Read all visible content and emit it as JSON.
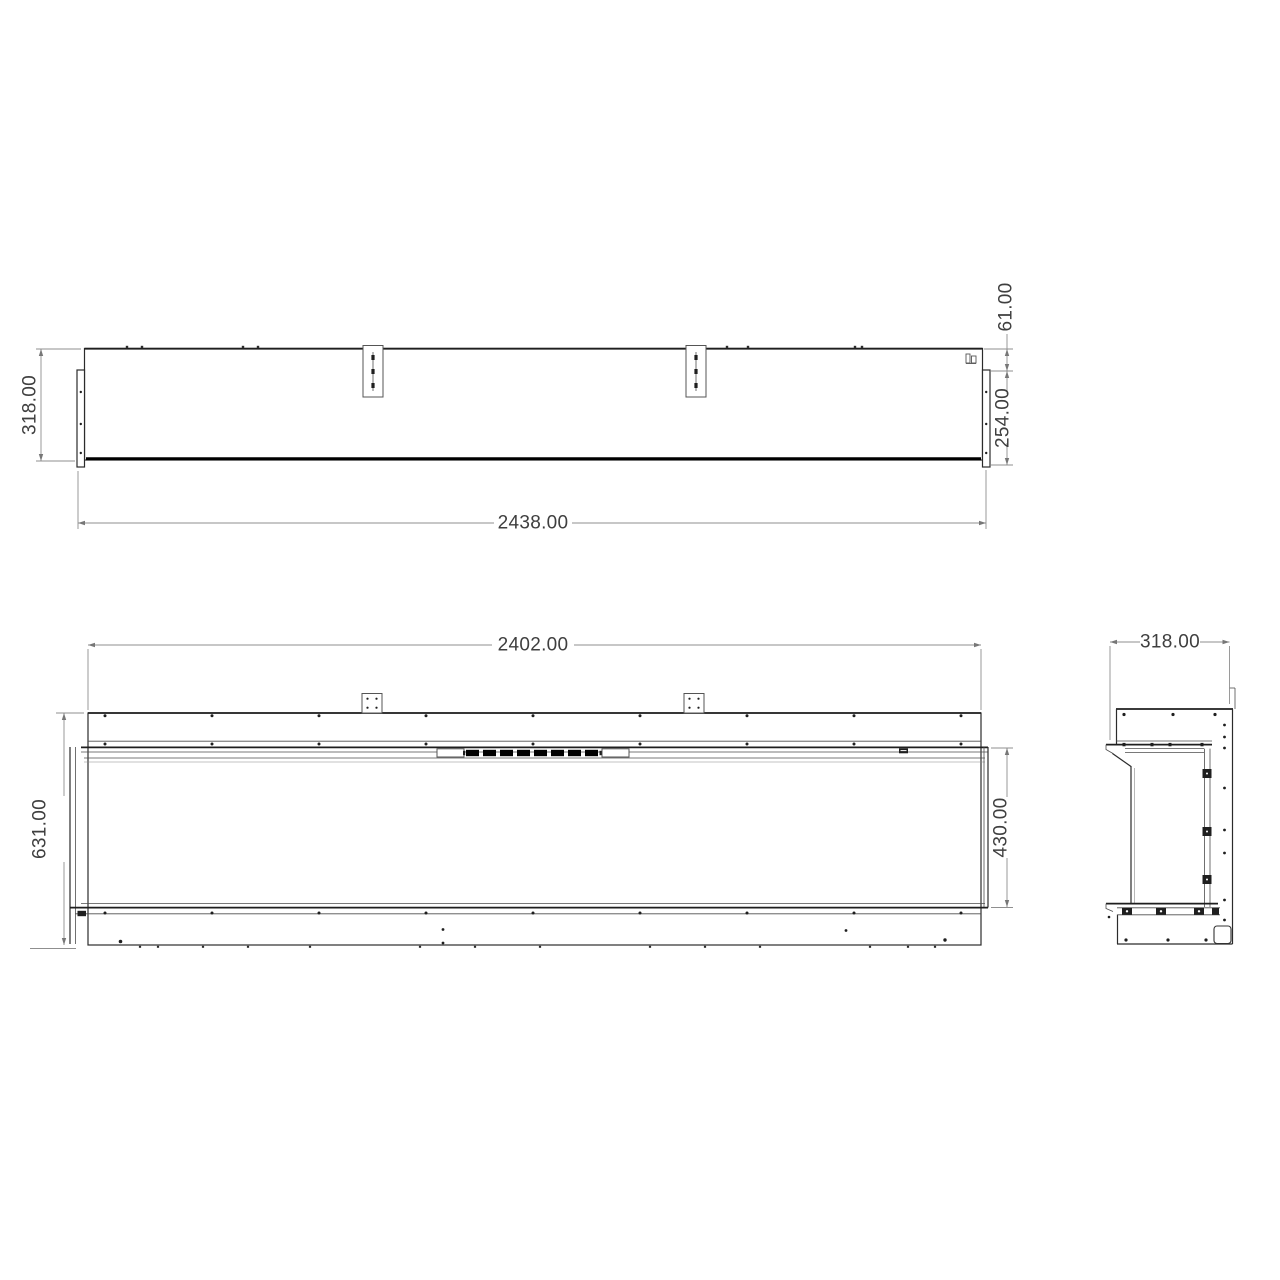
{
  "colors": {
    "background": "#ffffff",
    "part_line": "#2b2b2b",
    "glass_line": "#000000",
    "dimension_line": "#8f8f8f",
    "dimension_text": "#3f3f3f"
  },
  "views": {
    "top": {
      "dim_depth": "318.00",
      "dim_width": "2438.00",
      "dim_rear_offset": "61.00",
      "dim_front_depth": "254.00"
    },
    "front": {
      "dim_width": "2402.00",
      "dim_height": "631.00",
      "dim_opening_height": "430.00"
    },
    "side": {
      "dim_depth": "318.00"
    }
  }
}
